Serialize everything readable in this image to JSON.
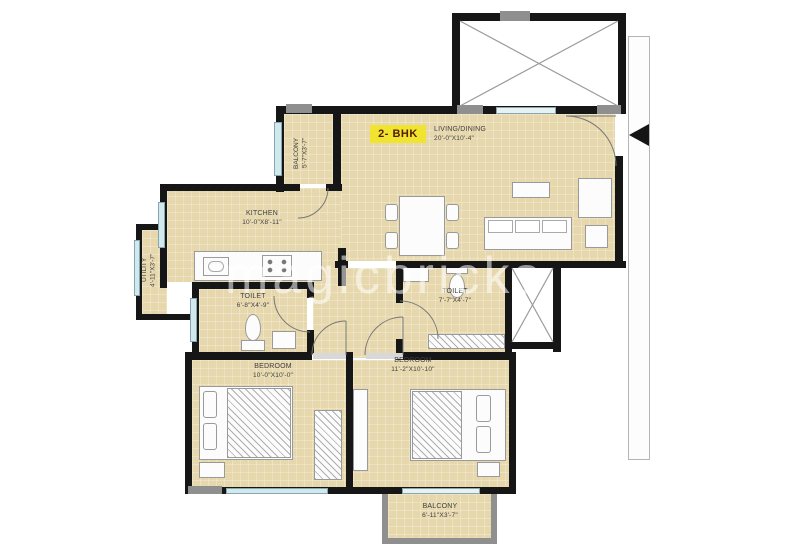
{
  "plan": {
    "badge": "2- BHK",
    "watermark": "magicbricks",
    "rooms": {
      "living": {
        "name": "LIVING/DINING",
        "dims": "20'-0\"X10'-4\""
      },
      "kitchen": {
        "name": "KITCHEN",
        "dims": "10'-0\"X8'-11\""
      },
      "utility": {
        "name": "UTILITY",
        "dims": "4'-11\"X3'-7\""
      },
      "toiletLeft": {
        "name": "TOILET",
        "dims": "6'-8\"X4'-9\""
      },
      "toiletRight": {
        "name": "TOILET",
        "dims": "7'-7\"X4'-7\""
      },
      "bedroomLeft": {
        "name": "BEDROOM",
        "dims": "10'-0\"X10'-0\""
      },
      "bedroomRight": {
        "name": "BEDROOM",
        "dims": "11'-2\"X10'-10\""
      },
      "balconyTop": {
        "name": "BALCONY",
        "dims": "5'-7\"X3'-7\""
      },
      "balconyBottom": {
        "name": "BALCONY",
        "dims": "6'-11\"X3'-7\""
      }
    },
    "colors": {
      "floor": "#e6d7ac",
      "wall": "#161616",
      "badge_bg": "#f0e42f",
      "badge_text": "#531c06",
      "window": "#cfe9ee",
      "watermark": "rgba(255,255,255,0.55)"
    }
  }
}
